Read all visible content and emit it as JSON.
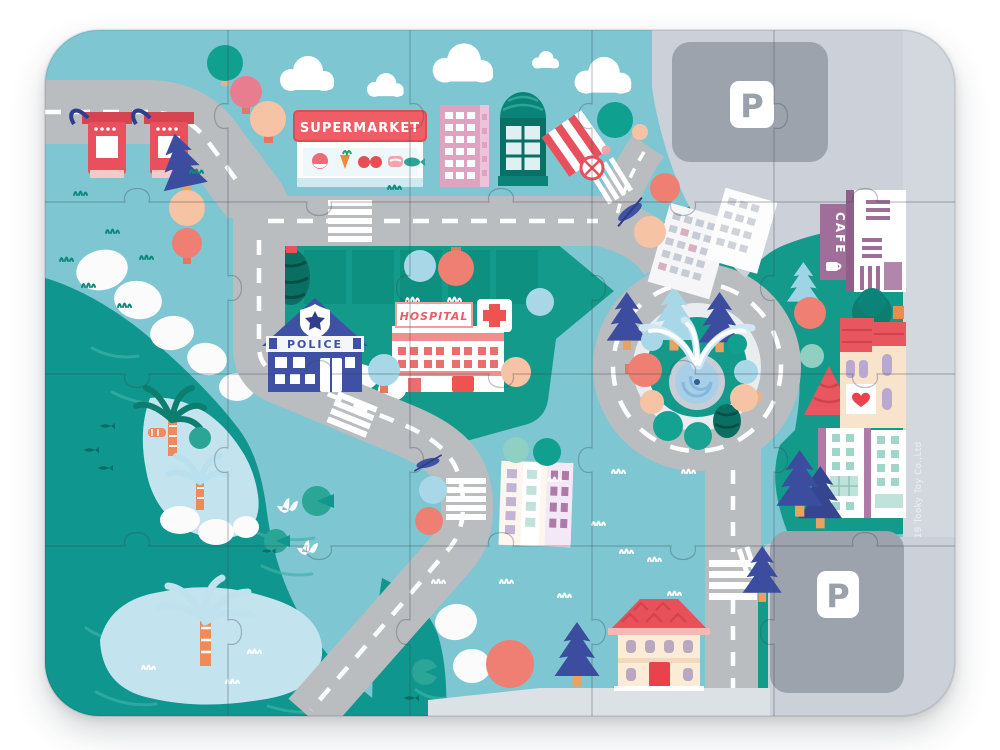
{
  "product": {
    "kind": "children city map jigsaw puzzle",
    "pieces_columns": 5,
    "pieces_rows": 4
  },
  "signs": {
    "supermarket": "SUPERMARKET",
    "hospital": "HOSPITAL",
    "police": "POLICE",
    "cafe": "CAFE",
    "parking_top": "P",
    "parking_bottom": "P",
    "copyright": "© 2019 Tooky Toy Co.,Ltd"
  },
  "colors": {
    "sky": "#7ec7d2",
    "park_teal": "#139a8b",
    "water_teal": "#0f968e",
    "road_gray": "#b9bdc0",
    "road_marking": "#ffffff",
    "parking_light": "#ccd1d9",
    "parking_pad": "#9da3ac",
    "sign_red": "#ef5d66",
    "police_blue": "#3e51a5",
    "hospital_pink": "#f08f8f",
    "cafe_purple": "#a06f99",
    "pine_blue": "#3c4da0",
    "island_blue": "#c3e4ee"
  }
}
